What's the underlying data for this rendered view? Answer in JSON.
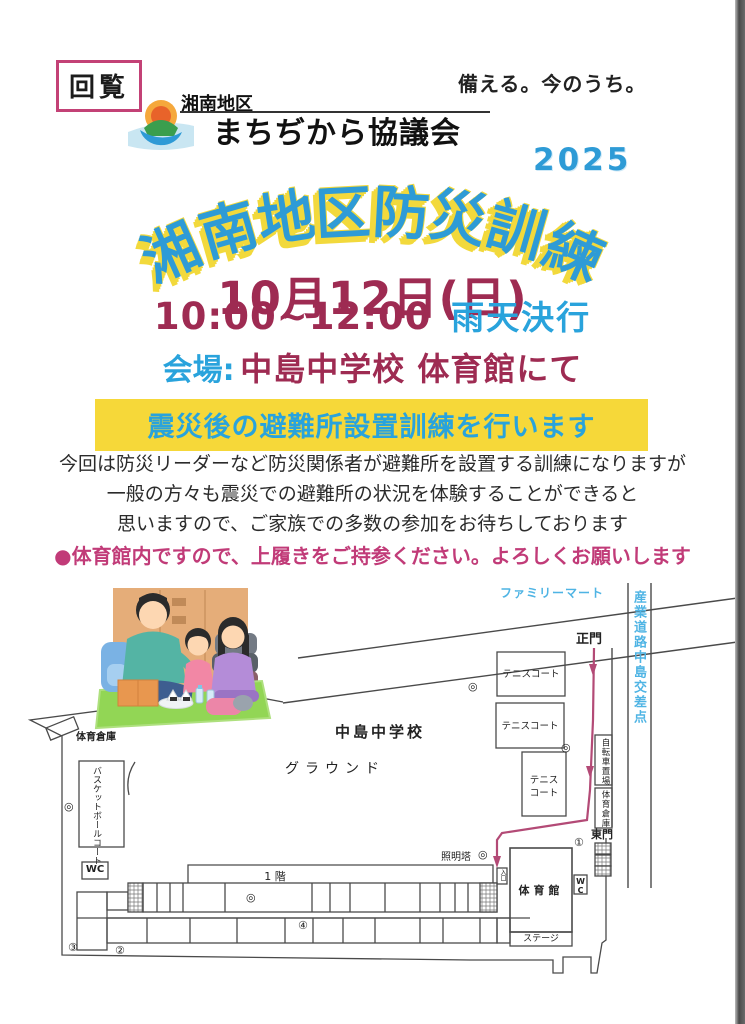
{
  "header": {
    "kairan": "回覧",
    "slogan": "備える。今のうち。"
  },
  "logo": {
    "district": "湘南地区",
    "org": "まちぢから協議会"
  },
  "title": {
    "year": "2025",
    "main_chars": [
      "湘",
      "南",
      "地",
      "区",
      "防",
      "災",
      "訓",
      "練"
    ],
    "date": "10月12日(日)",
    "time": "10:00~12:00",
    "rain": "雨天決行",
    "venue_label": "会場:",
    "venue": "中島中学校 体育館にて"
  },
  "banner": {
    "text": "震災後の避難所設置訓練を行います"
  },
  "body": {
    "line1": "今回は防災リーダーなど防災関係者が避難所を設置する訓練になりますが",
    "line2": "一般の方々も震災での避難所の状況を体験することができると",
    "line3": "思いますので、ご家族での多数の参加をお待ちしております"
  },
  "note": {
    "text": "●体育館内ですので、上履きをご持参ください。よろしくお願いします"
  },
  "map": {
    "labels": {
      "familymart": "ファミリーマート",
      "intersection": "産業道路中島交差点",
      "main_gate": "正門",
      "east_gate": "東門",
      "school": "中島中学校",
      "ground": "グラウンド",
      "gym_storage": "体育倉庫",
      "tennis": "テニスコート",
      "tennis3_line1": "テニス",
      "tennis3_line2": "コート",
      "basketball": "バスケットボールコート",
      "wc": "WC",
      "first_floor": "1 階",
      "light_tower": "照明塔",
      "bicycle": "自転車置場",
      "gym": "体育館",
      "stage": "ステージ",
      "entrance": "入口"
    },
    "markers": {
      "no1": "①",
      "no2": "②",
      "no3": "③",
      "no4": "④",
      "double_circle": "◎"
    }
  },
  "colors": {
    "title_blue": "#2e9bd6",
    "title_shadow_yellow": "#f2d93c",
    "maroon": "#9e2b52",
    "accent_blue": "#29a3dc",
    "banner_yellow": "#f6d839",
    "note_pink": "#c13b78",
    "kairan_border": "#c34176",
    "map_blue": "#4fb4e4",
    "route_pink": "#b34a76"
  }
}
